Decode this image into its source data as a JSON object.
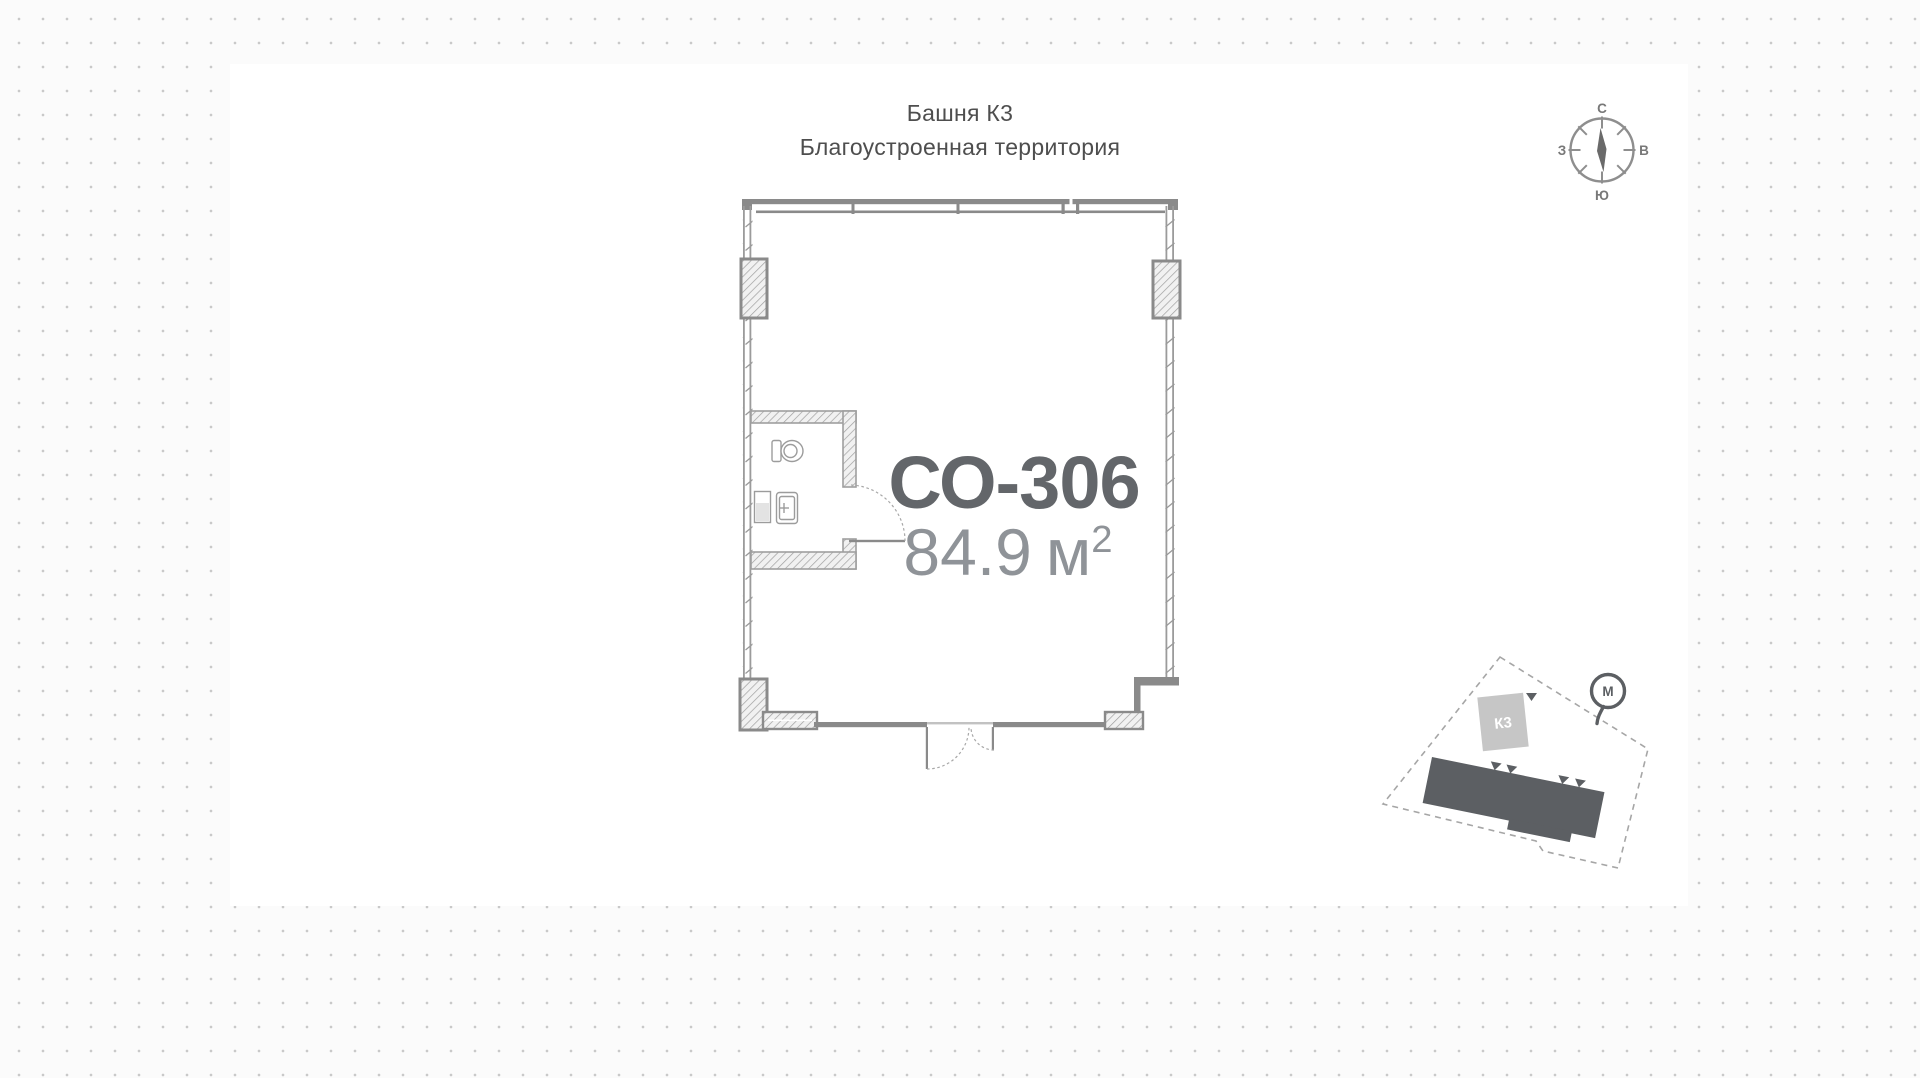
{
  "header": {
    "building": "Башня К3",
    "subtitle": "Благоустроенная территория"
  },
  "unit": {
    "id": "СО-306",
    "area_value": "84.9",
    "area_unit": "м",
    "area_exponent": "2"
  },
  "compass": {
    "north": "С",
    "south": "Ю",
    "west": "З",
    "east": "В"
  },
  "site_plan": {
    "tower_label": "К3",
    "metro_label": "М"
  },
  "colors": {
    "wall": "#8a8a8a",
    "hatch_line": "#9f9f9f",
    "glaze": "#9b9b9b",
    "text_primary": "#4e4e4e",
    "unit_id": "#63666a",
    "unit_area": "#8f9398",
    "site_dark": "#5c5f63",
    "site_light_block": "#c6c6c6",
    "dot": "#c9c9c9",
    "arc": "#a8a8a8",
    "fixture": "#9c9c9c",
    "compass": "#8e8e8e",
    "compass_text": "#787878"
  }
}
